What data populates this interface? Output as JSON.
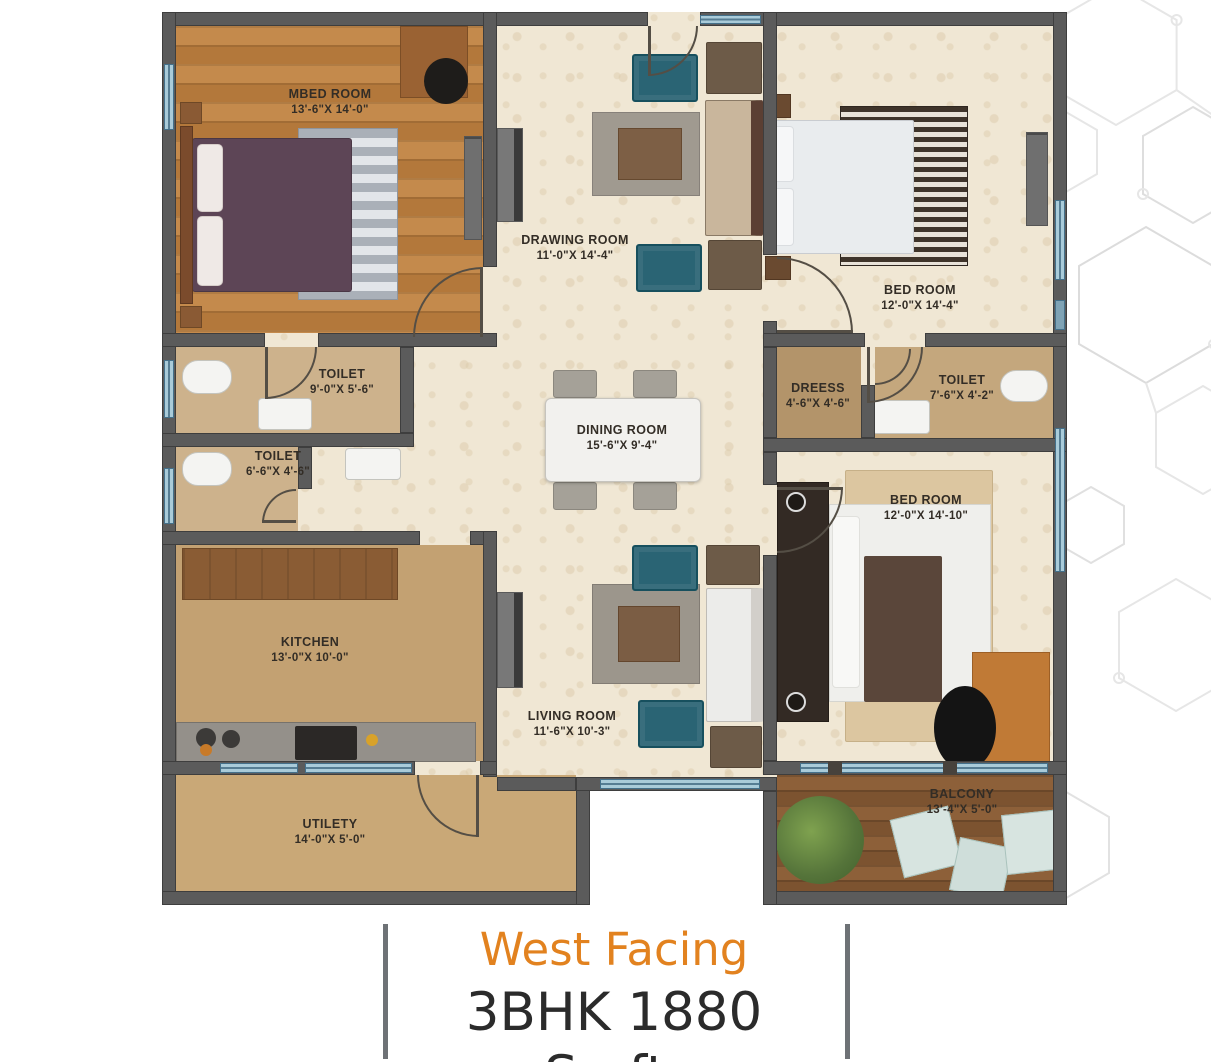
{
  "plan_title": "3BHK Floor Plan",
  "caption": {
    "facing": "West Facing",
    "spec": "3BHK 1880 Sq.ft."
  },
  "rooms": [
    {
      "name": "MBED ROOM",
      "dims": "13'-6\"X 14'-0\""
    },
    {
      "name": "DRAWING ROOM",
      "dims": "11'-0\"X 14'-4\""
    },
    {
      "name": "BED ROOM",
      "dims": "12'-0\"X 14'-4\""
    },
    {
      "name": "TOILET",
      "dims": "9'-0\"X 5'-6\""
    },
    {
      "name": "TOILET",
      "dims": "6'-6\"X 4'-6\""
    },
    {
      "name": "DREESS",
      "dims": "4'-6\"X 4'-6\""
    },
    {
      "name": "TOILET",
      "dims": "7'-6\"X 4'-2\""
    },
    {
      "name": "DINING ROOM",
      "dims": "15'-6\"X 9'-4\""
    },
    {
      "name": "BED ROOM",
      "dims": "12'-0\"X 14'-10\""
    },
    {
      "name": "KITCHEN",
      "dims": "13'-0\"X 10'-0\""
    },
    {
      "name": "LIVING ROOM",
      "dims": "11'-6\"X 10'-3\""
    },
    {
      "name": "UTILETY",
      "dims": "14'-0\"X 5'-0\""
    },
    {
      "name": "BALCONY",
      "dims": "13'-4\"X 5'-0\""
    }
  ],
  "colors": {
    "accent_orange": "#e2821f",
    "caption_dark": "#2b2b2b",
    "wall_gray": "#5b5b5b",
    "window_blue": "#a9cbd9",
    "floor_cream": "#f0e7d4",
    "floor_wood": "#bd8145",
    "floor_tan": "#c3a172",
    "teal_furniture": "#2a6474"
  }
}
